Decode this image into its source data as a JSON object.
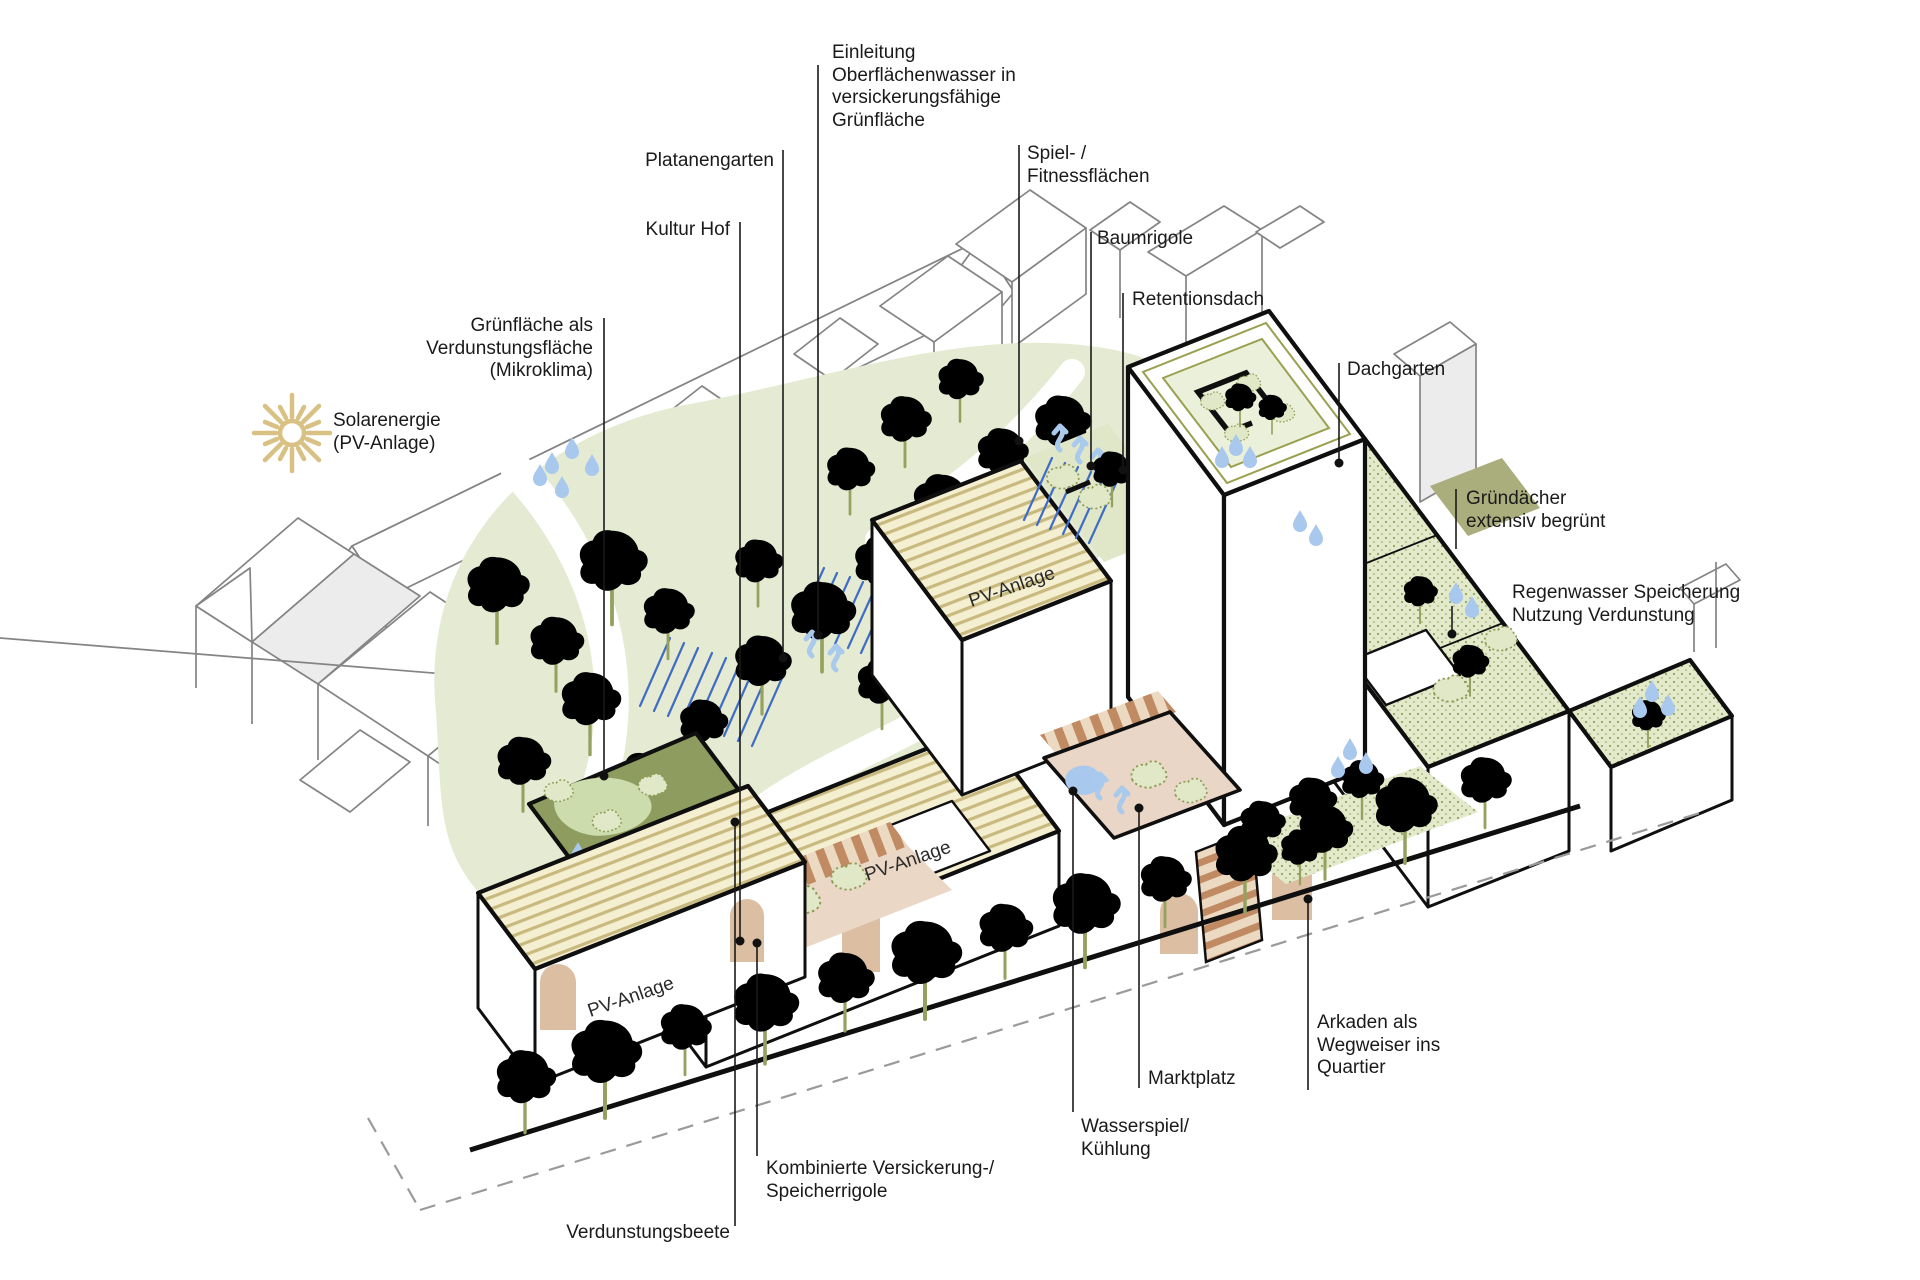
{
  "labels": {
    "einleitung": {
      "text": "Einleitung\nOberflächenwasser in\nversickerungsfähige\nGrünfläche"
    },
    "platanengarten": {
      "text": "Platanengarten"
    },
    "kultur_hof": {
      "text": "Kultur Hof"
    },
    "gru_verdunstung": {
      "text": "Grünfläche als\nVerdunstungsfläche\n(Mikroklima)"
    },
    "solarenergie": {
      "text": "Solarenergie\n(PV-Anlage)"
    },
    "spiel_fitness": {
      "text": "Spiel- /\nFitnessflächen"
    },
    "baumrigole": {
      "text": "Baumrigole"
    },
    "retentionsdach": {
      "text": "Retentionsdach"
    },
    "dachgarten": {
      "text": "Dachgarten"
    },
    "gruendaecher": {
      "text": "Gründächer\nextensiv begrünt"
    },
    "regenwasser": {
      "text": "Regenwasser Speicherung\nNutzung Verdunstung"
    },
    "arkaden": {
      "text": "Arkaden als\nWegweiser ins\nQuartier"
    },
    "marktplatz": {
      "text": "Marktplatz"
    },
    "wasserspiel": {
      "text": "Wasserspiel/\nKühlung"
    },
    "kombinierte": {
      "text": "Kombinierte Versickerung-/\nSpeicherrigole"
    },
    "verdunstungsbeete": {
      "text": "Verdunstungsbeete"
    }
  },
  "roof_labels": {
    "pv_anlage": "PV-Anlage"
  },
  "colors": {
    "text": "#1a1a1a",
    "context_line": "#848484",
    "building_line": "#0f0f0f",
    "park_green": "#e4ebd2",
    "tree_green": "#cfdba8",
    "tree_outline": "#96a160",
    "dark_bed_green": "#8e9d5f",
    "pv_roof": "#f5efd2",
    "pv_stripe": "#c8b97e",
    "extensive_roof": "#e3eacc",
    "terracotta": "#c08a63",
    "plaza_pink": "#ead6c6",
    "arch_tan": "#dcbfa2",
    "water_blue": "#a8c8ee",
    "hatch_blue": "#3f6cc4",
    "sun_gold": "#d9c083",
    "roof_ring_olive": "#9aa050"
  }
}
